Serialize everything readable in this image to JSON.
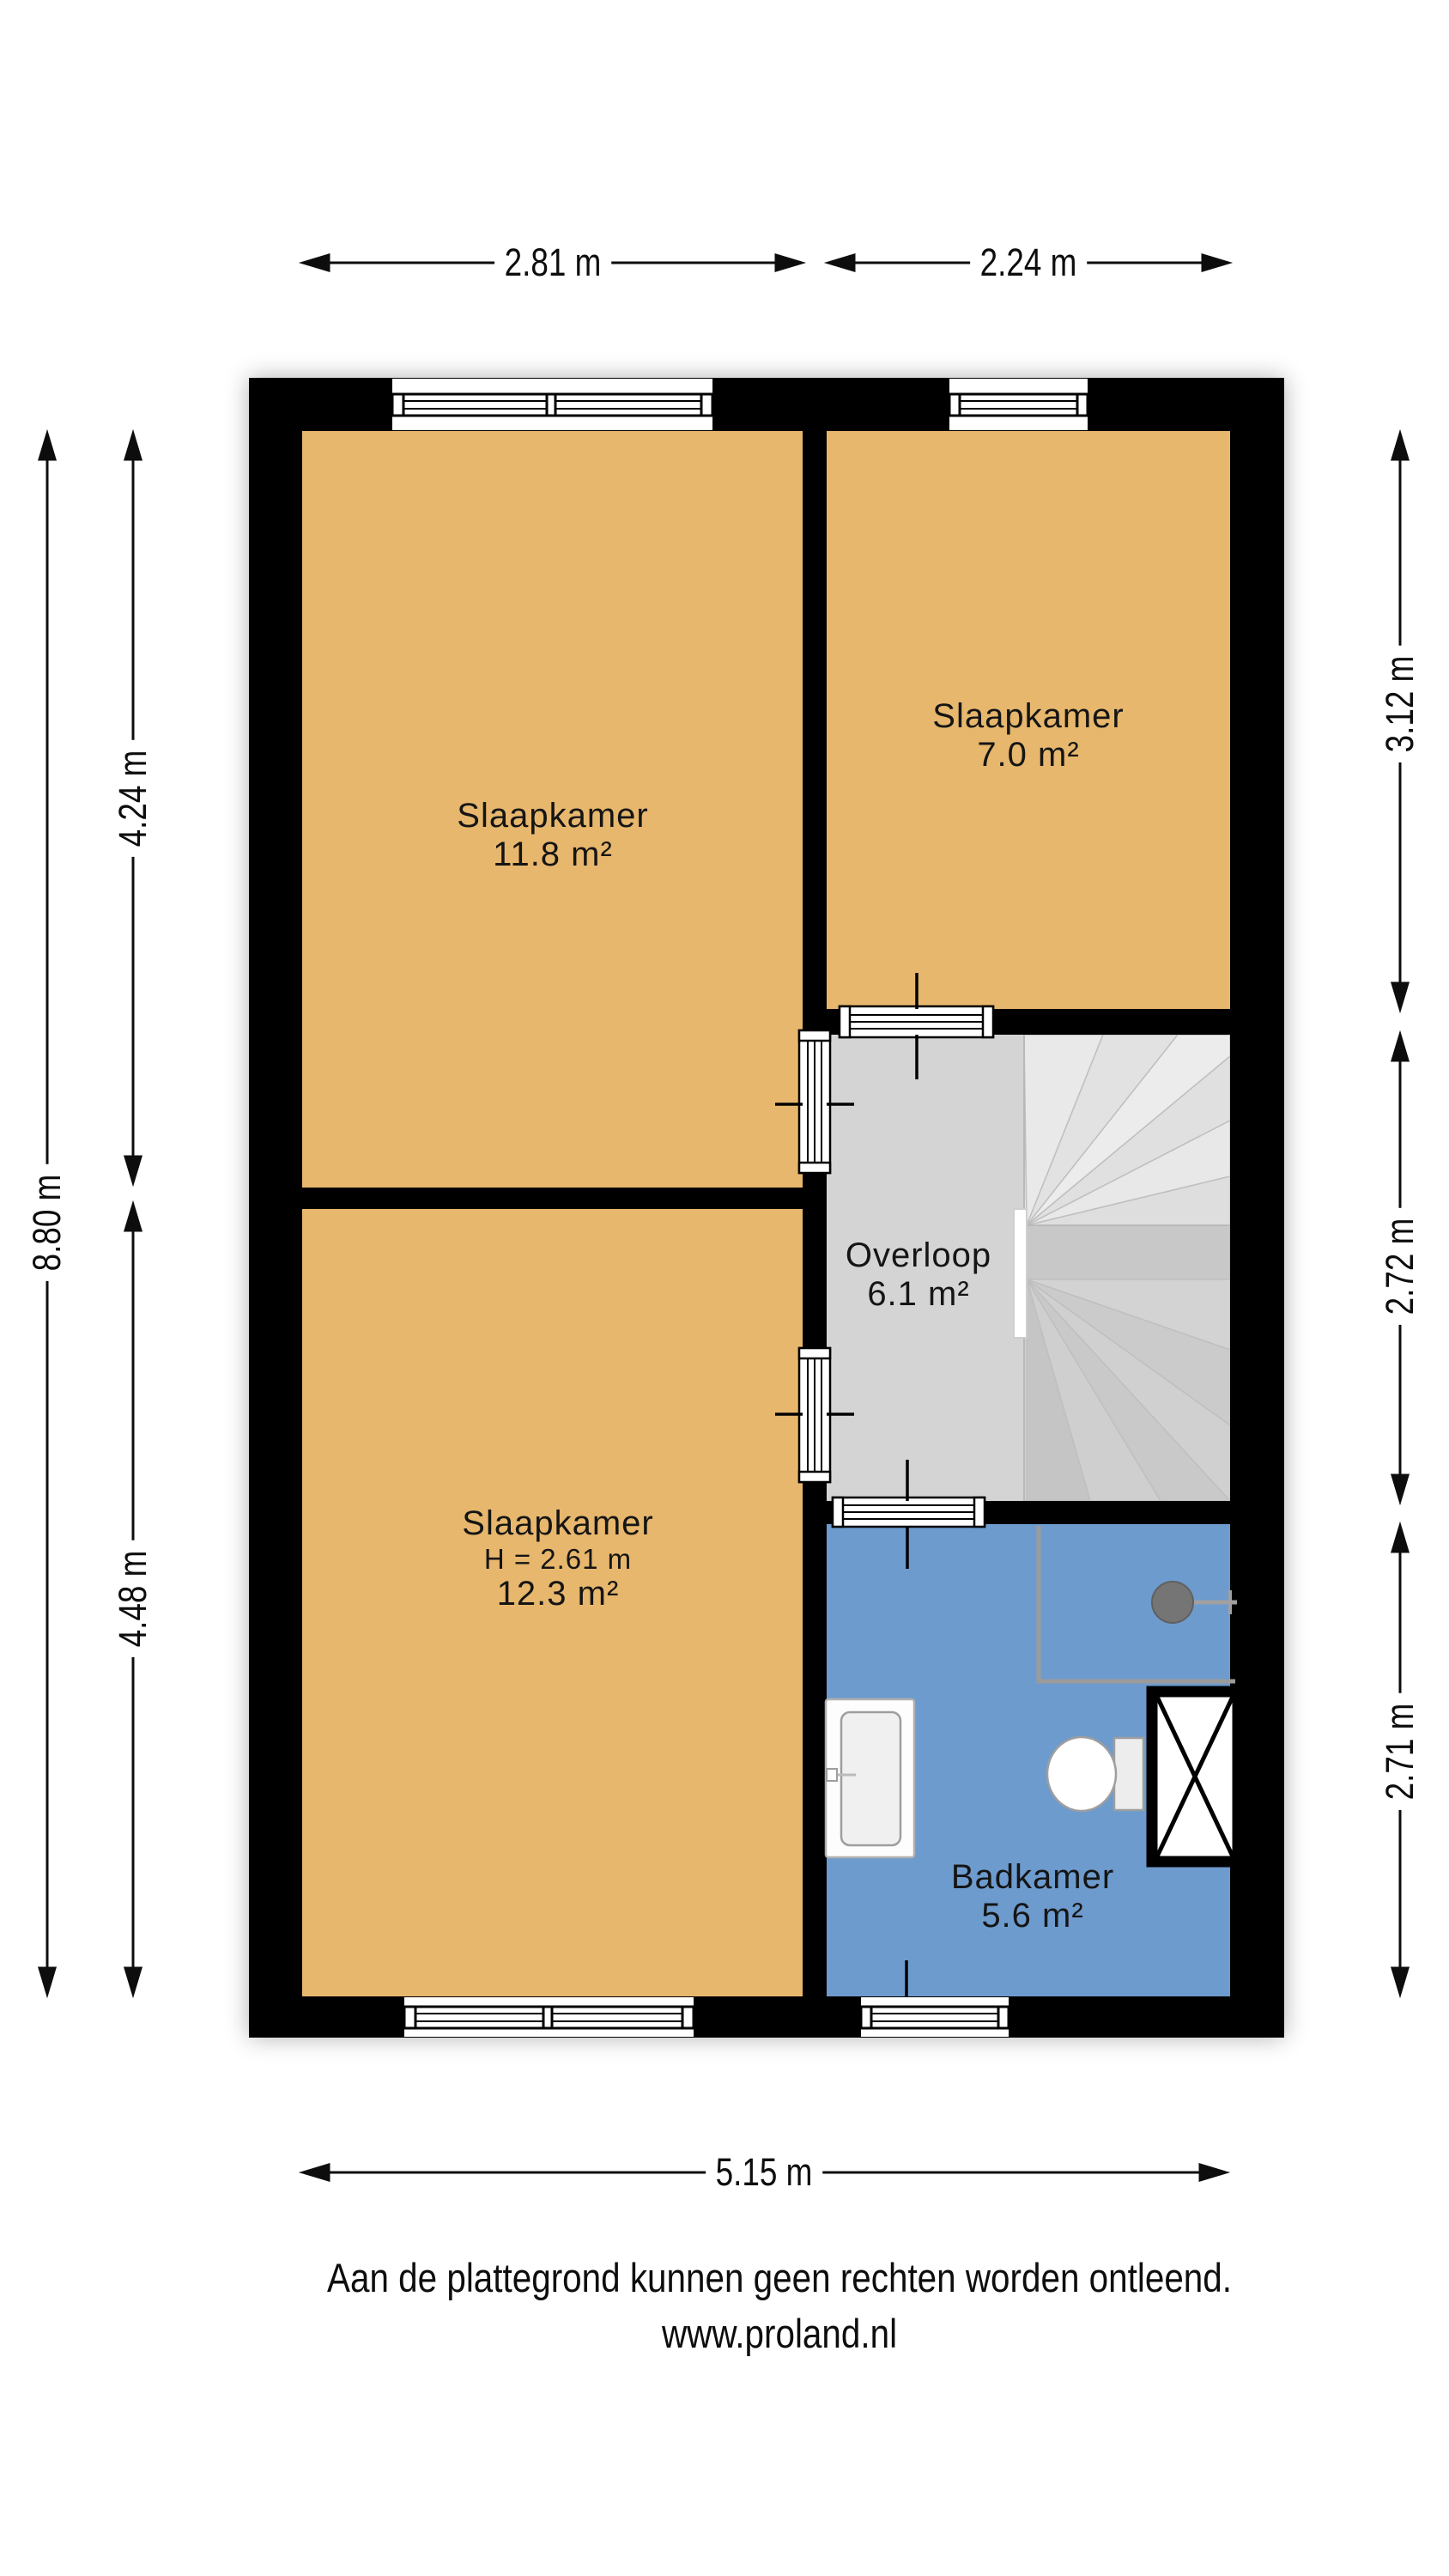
{
  "plan": {
    "rooms": [
      {
        "key": "slaapkamer-groot",
        "label": "Slaapkamer",
        "area": "11.8 m²"
      },
      {
        "key": "slaapkamer-klein",
        "label": "Slaapkamer",
        "area": "7.0 m²"
      },
      {
        "key": "overloop",
        "label": "Overloop",
        "area": "6.1 m²"
      },
      {
        "key": "slaapkamer-achter",
        "label": "Slaapkamer",
        "height_note": "H = 2.61 m",
        "area": "12.3 m²"
      },
      {
        "key": "badkamer",
        "label": "Badkamer",
        "area": "5.6 m²"
      }
    ]
  },
  "dimensions": {
    "top": [
      "2.81 m",
      "2.24 m"
    ],
    "left_outer": "8.80 m",
    "left": [
      "4.24 m",
      "4.48 m"
    ],
    "right": [
      "3.12 m",
      "2.72 m",
      "2.71 m"
    ],
    "bottom": "5.15 m"
  },
  "footer": {
    "disclaimer": "Aan de plattegrond kunnen geen rechten worden ontleend.",
    "website": "www.proland.nl"
  },
  "colors": {
    "wall": "#000000",
    "bedroom_fill": "#e7b76d",
    "bathroom_fill": "#6d9bce",
    "landing_fill": "#d4d4d4",
    "stairs_fill": "#dcdcdc",
    "dimension_text": "#0d0d0d"
  }
}
